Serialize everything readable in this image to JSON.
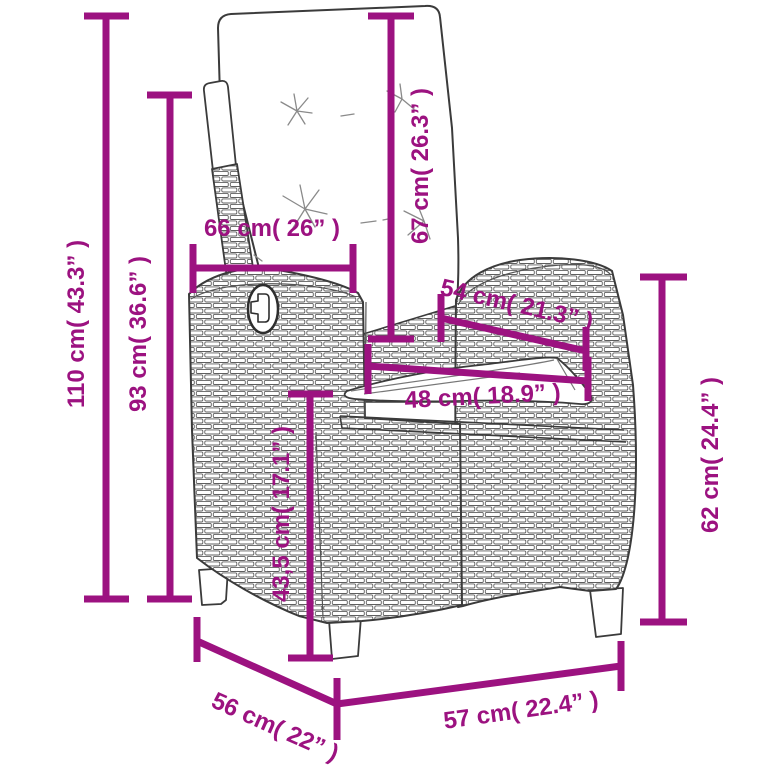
{
  "diagram": {
    "title": "Reclining wicker garden chair with cushions – dimension drawing",
    "accent_color": "#9C1280",
    "outline_color": "#3B3B3B",
    "dimensions": {
      "total_height": "110 cm( 43.3” )",
      "backrest_height": "93 cm( 36.6” )",
      "backrest_width": "66 cm( 26” )",
      "back_cushion_length": "67 cm( 26.3” )",
      "armrest_depth": "54 cm( 21.3” )",
      "seat_width": "48 cm( 18.9” )",
      "seat_height": "43,5 cm( 17.1” )",
      "armrest_height": "62 cm( 24.4” )",
      "seat_depth": "56 cm( 22” )",
      "total_width": "57 cm( 22.4” )"
    }
  }
}
